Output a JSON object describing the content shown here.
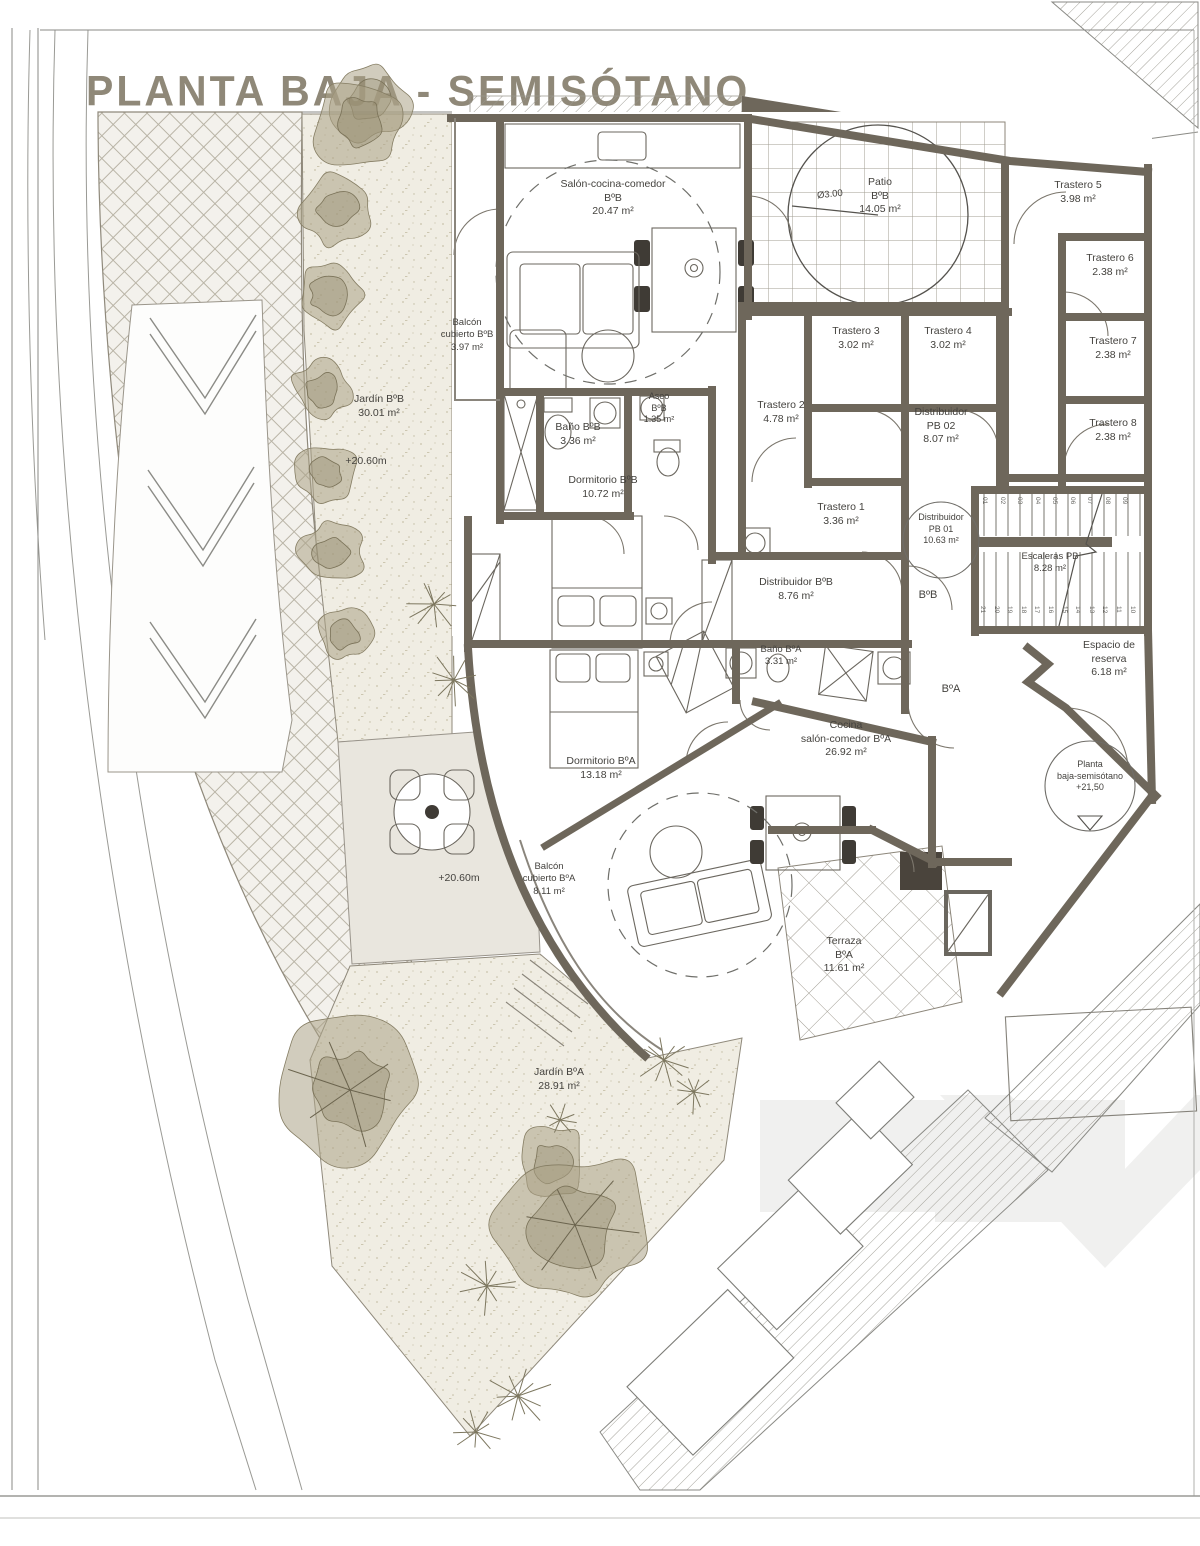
{
  "title": "PLANTA BAJA - SEMISÓTANO",
  "colors": {
    "wall": "#6e675b",
    "title_text": "#8f8878",
    "label_text": "#44423e",
    "garden_background": "#f0ede3",
    "garden_dots": "#c9c2aa",
    "tree": "#a49b80",
    "hatch_lines": "#b9b4a6",
    "watermark": "#efefef"
  },
  "rooms": {
    "salon_bb": {
      "lines": [
        "Salón-cocina-comedor",
        "BºB",
        "20.47 m²"
      ]
    },
    "patio_bb": {
      "lines": [
        "Patio",
        "BºB",
        "14.05 m²"
      ]
    },
    "patio_diameter": {
      "lines": [
        "Ø3.00"
      ]
    },
    "trastero5": {
      "lines": [
        "Trastero 5",
        "3.98 m²"
      ]
    },
    "trastero6": {
      "lines": [
        "Trastero 6",
        "2.38 m²"
      ]
    },
    "trastero7": {
      "lines": [
        "Trastero 7",
        "2.38 m²"
      ]
    },
    "trastero8": {
      "lines": [
        "Trastero 8",
        "2.38 m²"
      ]
    },
    "trastero3": {
      "lines": [
        "Trastero 3",
        "3.02 m²"
      ]
    },
    "trastero4": {
      "lines": [
        "Trastero 4",
        "3.02 m²"
      ]
    },
    "trastero2": {
      "lines": [
        "Trastero 2",
        "4.78 m²"
      ]
    },
    "trastero1": {
      "lines": [
        "Trastero 1",
        "3.36 m²"
      ]
    },
    "distribuidor_pb02": {
      "lines": [
        "Distribuidor",
        "PB 02",
        "8.07 m²"
      ]
    },
    "distribuidor_pb01": {
      "lines": [
        "Distribuidor",
        "PB 01",
        "10.63 m²"
      ]
    },
    "escaleras_pb": {
      "lines": [
        "Escaleras PB",
        "8.28 m²"
      ]
    },
    "balcon_cubierto_bb": {
      "lines": [
        "Balcón",
        "cubierto BºB",
        "3.97 m²"
      ]
    },
    "jardin_bb": {
      "lines": [
        "Jardín BºB",
        "30.01 m²"
      ]
    },
    "cota_jardin_bb": {
      "lines": [
        "+20.60m"
      ]
    },
    "bano_bb": {
      "lines": [
        "Baño BºB",
        "3.36 m²"
      ]
    },
    "aseo_bb": {
      "lines": [
        "Aseo",
        "BºB",
        "1.35 m²"
      ]
    },
    "dormitorio_bb": {
      "lines": [
        "Dormitorio BºB",
        "10.72 m²"
      ]
    },
    "distribuidor_bb": {
      "lines": [
        "Distribuidor BºB",
        "8.76 m²"
      ]
    },
    "bano_ba": {
      "lines": [
        "Baño BºA",
        "3.31 m²"
      ]
    },
    "unit_bb": {
      "lines": [
        "BºB"
      ]
    },
    "unit_ba": {
      "lines": [
        "BºA"
      ]
    },
    "cocina_ba": {
      "lines": [
        "Cocina",
        "salón-comedor BºA",
        "26.92 m²"
      ]
    },
    "espacio_reserva": {
      "lines": [
        "Espacio de",
        "reserva",
        "6.18 m²"
      ]
    },
    "planta_cota": {
      "lines": [
        "Planta",
        "baja-semisótano",
        "+21,50"
      ]
    },
    "dormitorio_ba": {
      "lines": [
        "Dormitorio BºA",
        "13.18 m²"
      ]
    },
    "balcon_cubierto_ba": {
      "lines": [
        "Balcón",
        "cubierto BºA",
        "8.11 m²"
      ]
    },
    "cota_patio_ba": {
      "lines": [
        "+20.60m"
      ]
    },
    "jardin_ba": {
      "lines": [
        "Jardín BºA",
        "28.91 m²"
      ]
    },
    "terraza_ba": {
      "lines": [
        "Terraza",
        "BºA",
        "11.61 m²"
      ]
    }
  },
  "stairs": {
    "step_numbers_top": [
      "01",
      "02",
      "03",
      "04",
      "05",
      "06",
      "07",
      "08",
      "09"
    ],
    "step_numbers_bottom": [
      "21",
      "20",
      "19",
      "18",
      "17",
      "16",
      "15",
      "14",
      "13",
      "12",
      "11",
      "10"
    ]
  }
}
